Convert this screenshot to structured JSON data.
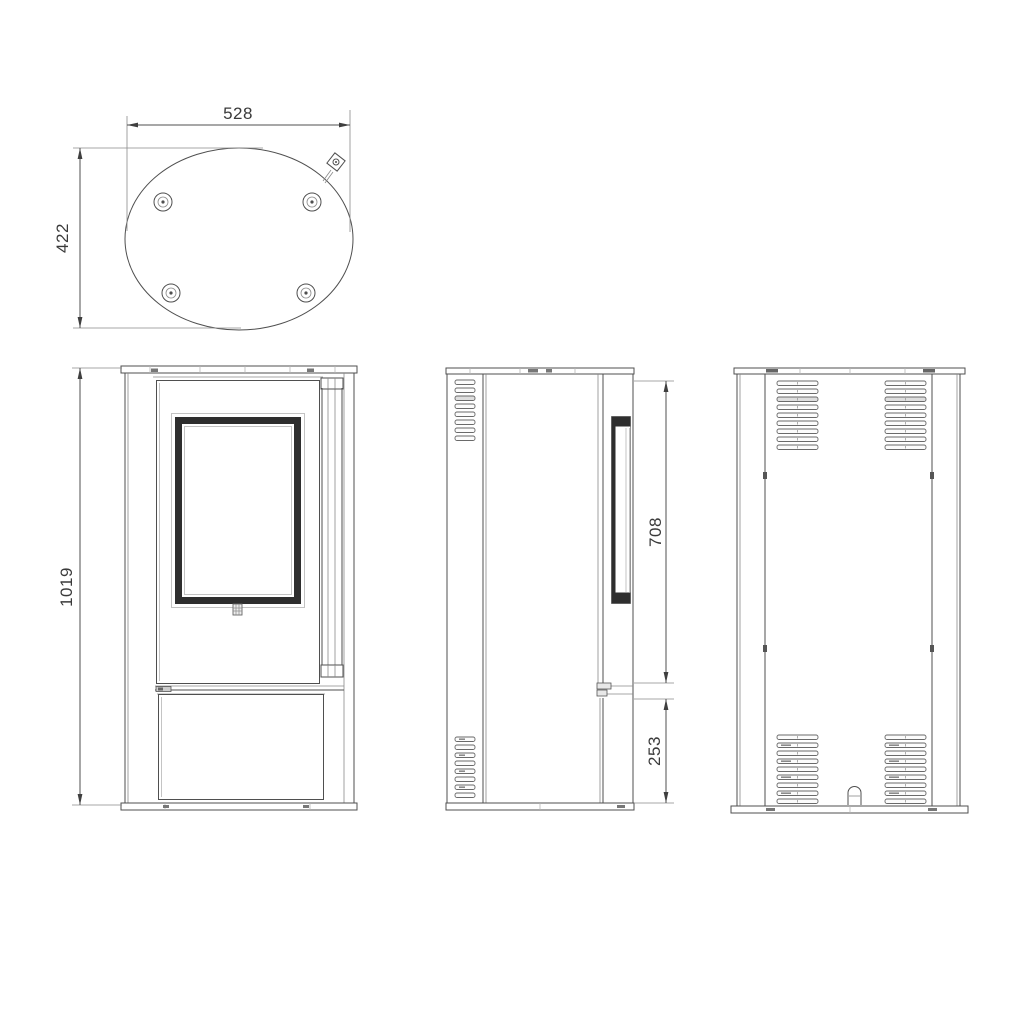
{
  "drawing": {
    "background_color": "#ffffff",
    "line_color": "#4f4f4f",
    "dark_accent_color": "#2e2e2e",
    "top_view": {
      "width": "528",
      "depth": "422"
    },
    "front_view": {
      "height": "1019"
    },
    "side_view": {
      "upper_section": "708",
      "lower_section": "253"
    }
  }
}
